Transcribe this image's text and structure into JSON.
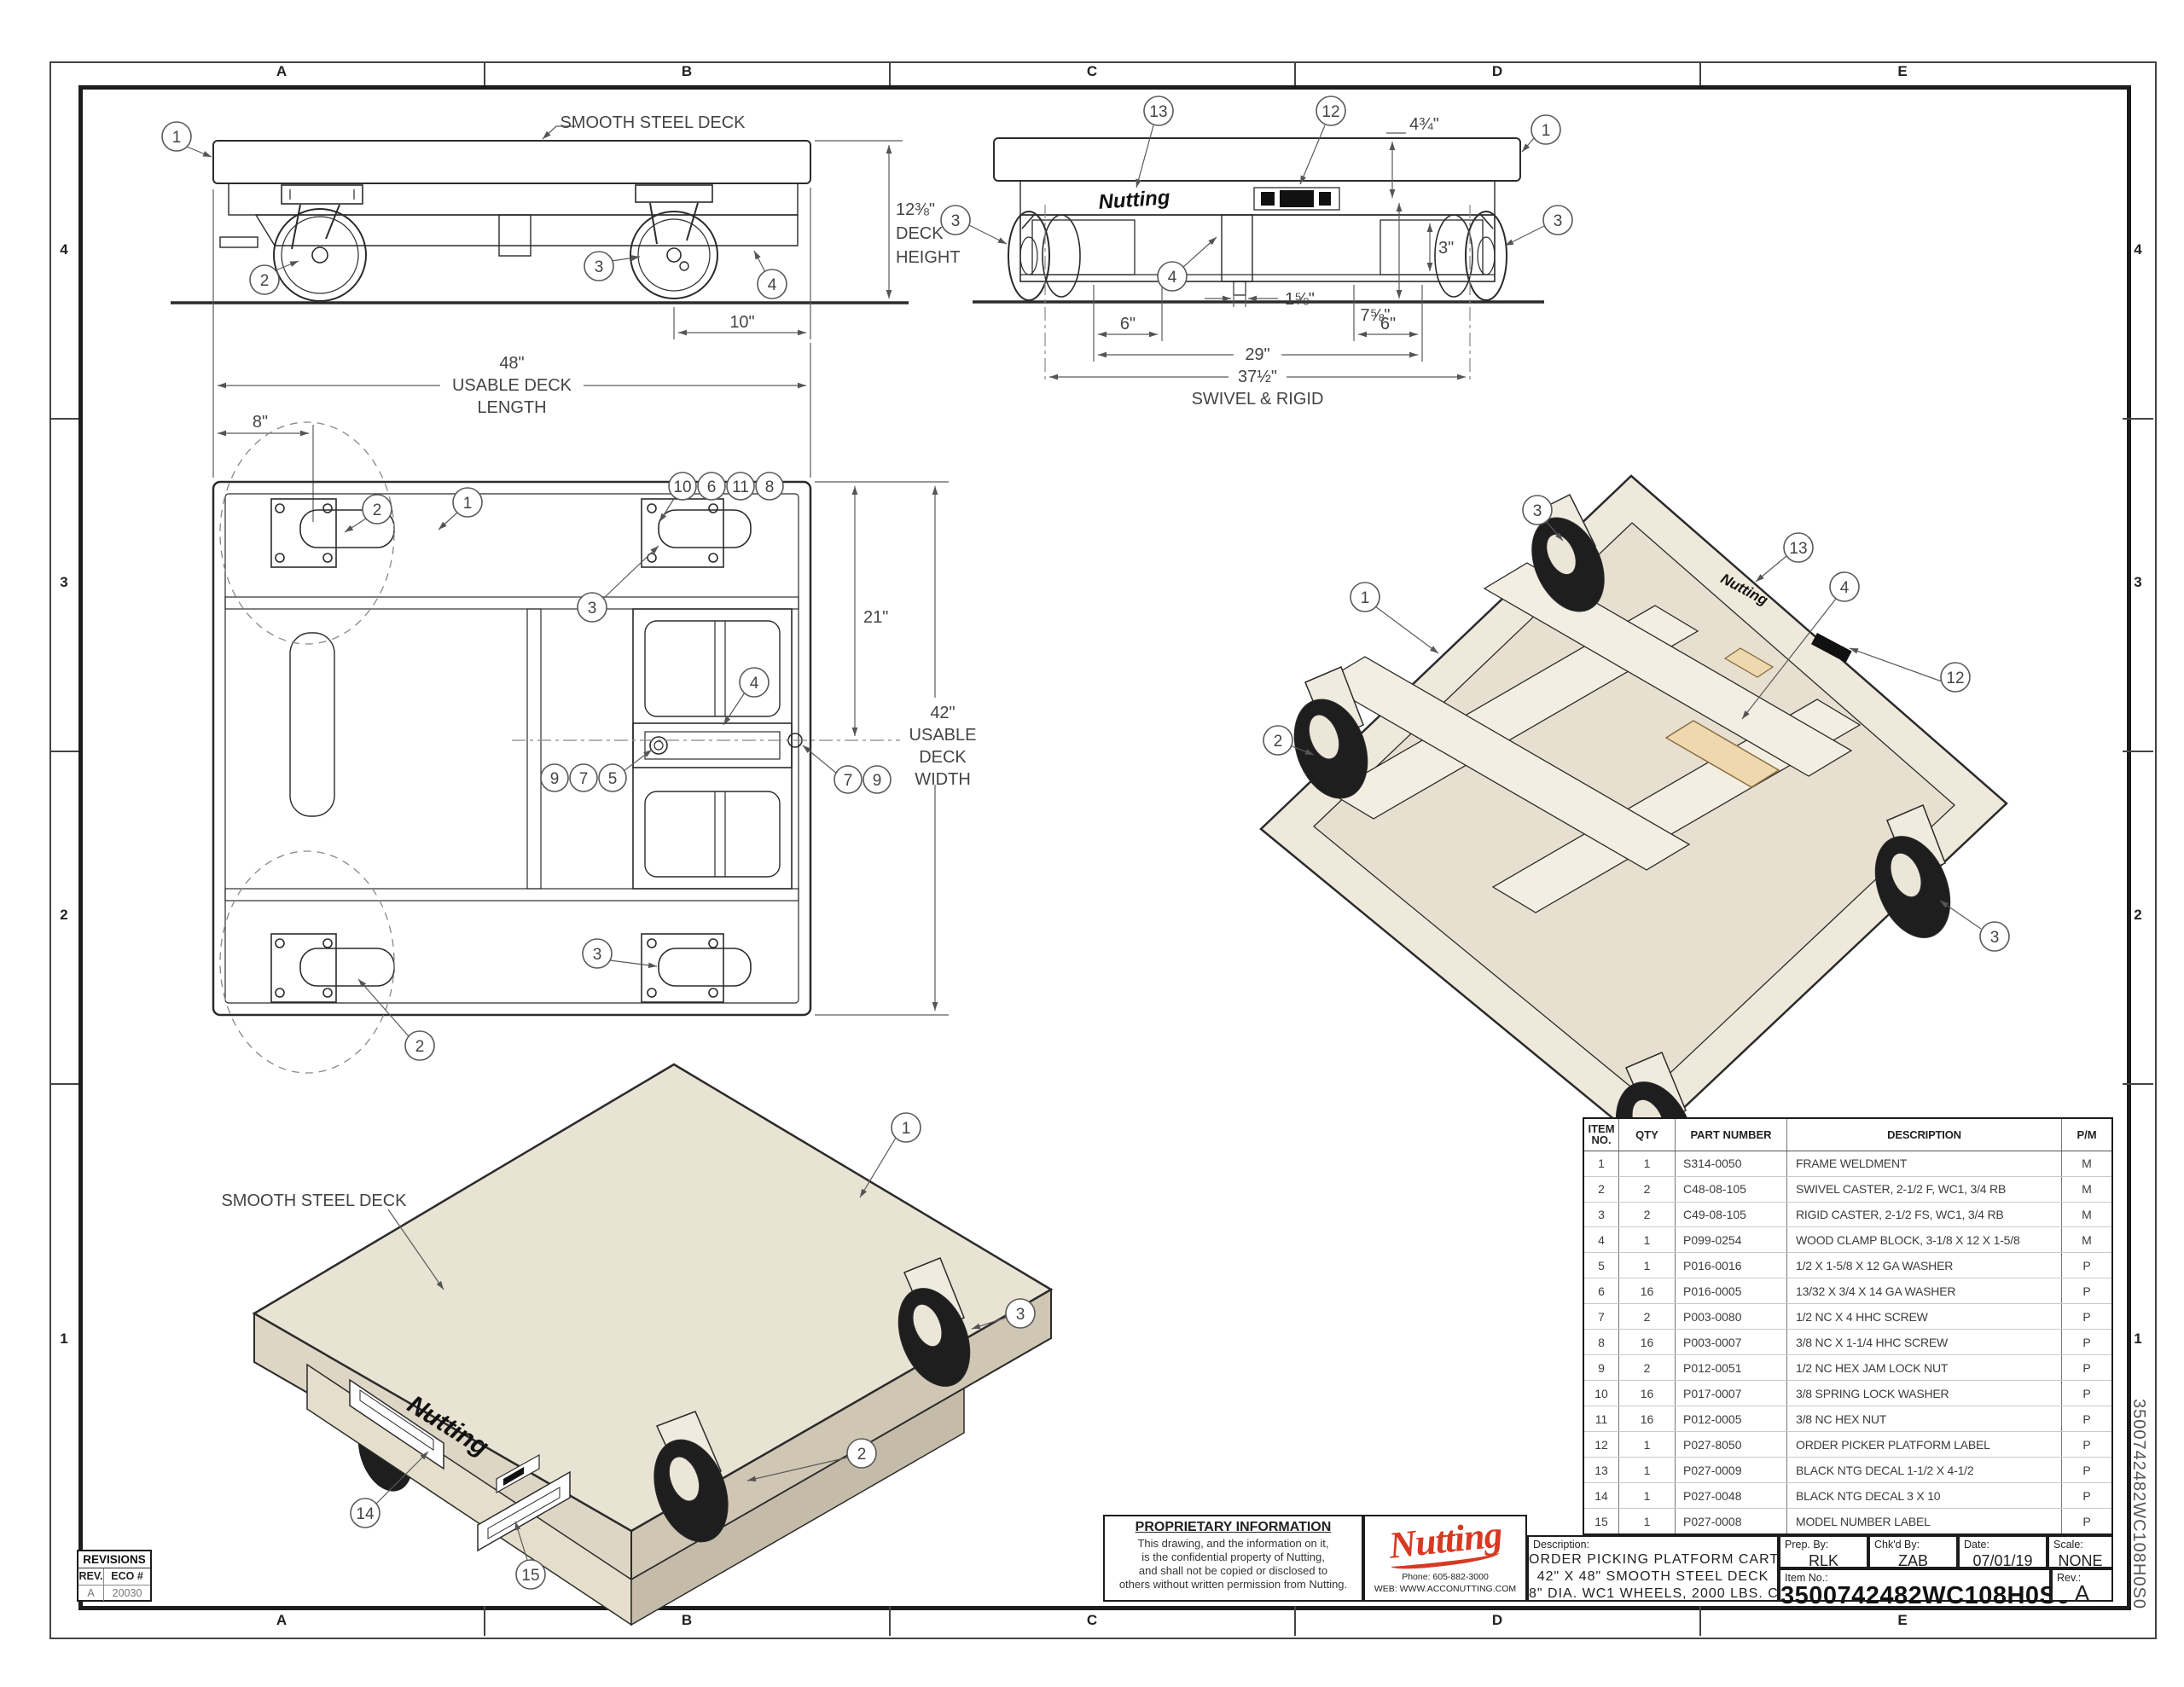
{
  "sheet": {
    "columns": [
      "A",
      "B",
      "C",
      "D",
      "E"
    ],
    "rows": [
      "4",
      "3",
      "2",
      "1"
    ]
  },
  "brand": {
    "name": "Nutting"
  },
  "balloons": {
    "n1": "1",
    "n2": "2",
    "n3": "3",
    "n4": "4",
    "n5": "5",
    "n6": "6",
    "n7": "7",
    "n8": "8",
    "n9": "9",
    "n10": "10",
    "n11": "11",
    "n12": "12",
    "n13": "13",
    "n14": "14",
    "n15": "15"
  },
  "labels": {
    "smooth_steel_deck": "SMOOTH STEEL DECK",
    "usable_deck": "USABLE DECK",
    "length": "LENGTH",
    "usable": "USABLE",
    "deck": "DECK",
    "width": "WIDTH",
    "height": "HEIGHT",
    "swivel_rigid": "SWIVEL & RIGID"
  },
  "dims": {
    "deck_height": "12⅜\"",
    "wheel_offset": "10\"",
    "deck_length": "48\"",
    "caster_offset": "8\"",
    "half_width": "21\"",
    "deck_width": "42\"",
    "top_height": "4¾\"",
    "box_height": "3\"",
    "under_height": "7⅝\"",
    "stem_offset": "1⅝\"",
    "six_left": "6\"",
    "six_right": "6\"",
    "rigid_span": "29\"",
    "overall_span": "37½\""
  },
  "bom": {
    "headers": {
      "item1": "ITEM",
      "item2": "NO.",
      "qty": "QTY",
      "part": "PART NUMBER",
      "desc": "DESCRIPTION",
      "pm": "P/M"
    },
    "rows": [
      [
        "1",
        "1",
        "S314-0050",
        "FRAME WELDMENT",
        "M"
      ],
      [
        "2",
        "2",
        "C48-08-105",
        "SWIVEL CASTER, 2-1/2 F, WC1, 3/4 RB",
        "M"
      ],
      [
        "3",
        "2",
        "C49-08-105",
        "RIGID CASTER, 2-1/2 FS, WC1, 3/4 RB",
        "M"
      ],
      [
        "4",
        "1",
        "P099-0254",
        "WOOD CLAMP BLOCK, 3-1/8 X 12 X 1-5/8",
        "M"
      ],
      [
        "5",
        "1",
        "P016-0016",
        "1/2 X 1-5/8 X 12 GA WASHER",
        "P"
      ],
      [
        "6",
        "16",
        "P016-0005",
        "13/32 X 3/4 X 14 GA WASHER",
        "P"
      ],
      [
        "7",
        "2",
        "P003-0080",
        "1/2 NC X 4 HHC SCREW",
        "P"
      ],
      [
        "8",
        "16",
        "P003-0007",
        "3/8 NC X 1-1/4 HHC SCREW",
        "P"
      ],
      [
        "9",
        "2",
        "P012-0051",
        "1/2 NC HEX JAM LOCK NUT",
        "P"
      ],
      [
        "10",
        "16",
        "P017-0007",
        "3/8 SPRING LOCK WASHER",
        "P"
      ],
      [
        "11",
        "16",
        "P012-0005",
        "3/8 NC HEX NUT",
        "P"
      ],
      [
        "12",
        "1",
        "P027-8050",
        "ORDER PICKER PLATFORM LABEL",
        "P"
      ],
      [
        "13",
        "1",
        "P027-0009",
        "BLACK NTG DECAL 1-1/2 X 4-1/2",
        "P"
      ],
      [
        "14",
        "1",
        "P027-0048",
        "BLACK NTG DECAL 3 X 10",
        "P"
      ],
      [
        "15",
        "1",
        "P027-0008",
        "MODEL NUMBER LABEL",
        "P"
      ]
    ]
  },
  "title_block": {
    "proprietary": {
      "title": "PROPRIETARY INFORMATION",
      "lines": [
        "This drawing, and the information on it,",
        "is the confidential property of Nutting,",
        "and shall not be copied or disclosed to",
        "others without written permission from Nutting."
      ]
    },
    "logo": {
      "phone_label": "Phone:",
      "phone": "605-882-3000",
      "web_label": "WEB:",
      "web": "WWW.ACCONUTTING.COM"
    },
    "description_label": "Description:",
    "description_lines": [
      "ORDER PICKING PLATFORM CART",
      "42\" X 48\" SMOOTH STEEL DECK",
      "8\" DIA. WC1 WHEELS, 2000 LBS. CAPACITY"
    ],
    "prep_by_label": "Prep. By:",
    "prep_by": "RLK",
    "chkd_by_label": "Chk'd By:",
    "chkd_by": "ZAB",
    "date_label": "Date:",
    "date": "07/01/19",
    "scale_label": "Scale:",
    "scale": "NONE",
    "item_no_label": "Item No.:",
    "item_no": "3500742482WC108H0S0",
    "rev_label": "Rev.:",
    "rev": "A"
  },
  "revisions": {
    "title": "REVISIONS",
    "rev_header": "REV.",
    "eco_header": "ECO #",
    "rows": [
      {
        "rev": "A",
        "eco": "20030"
      }
    ]
  }
}
